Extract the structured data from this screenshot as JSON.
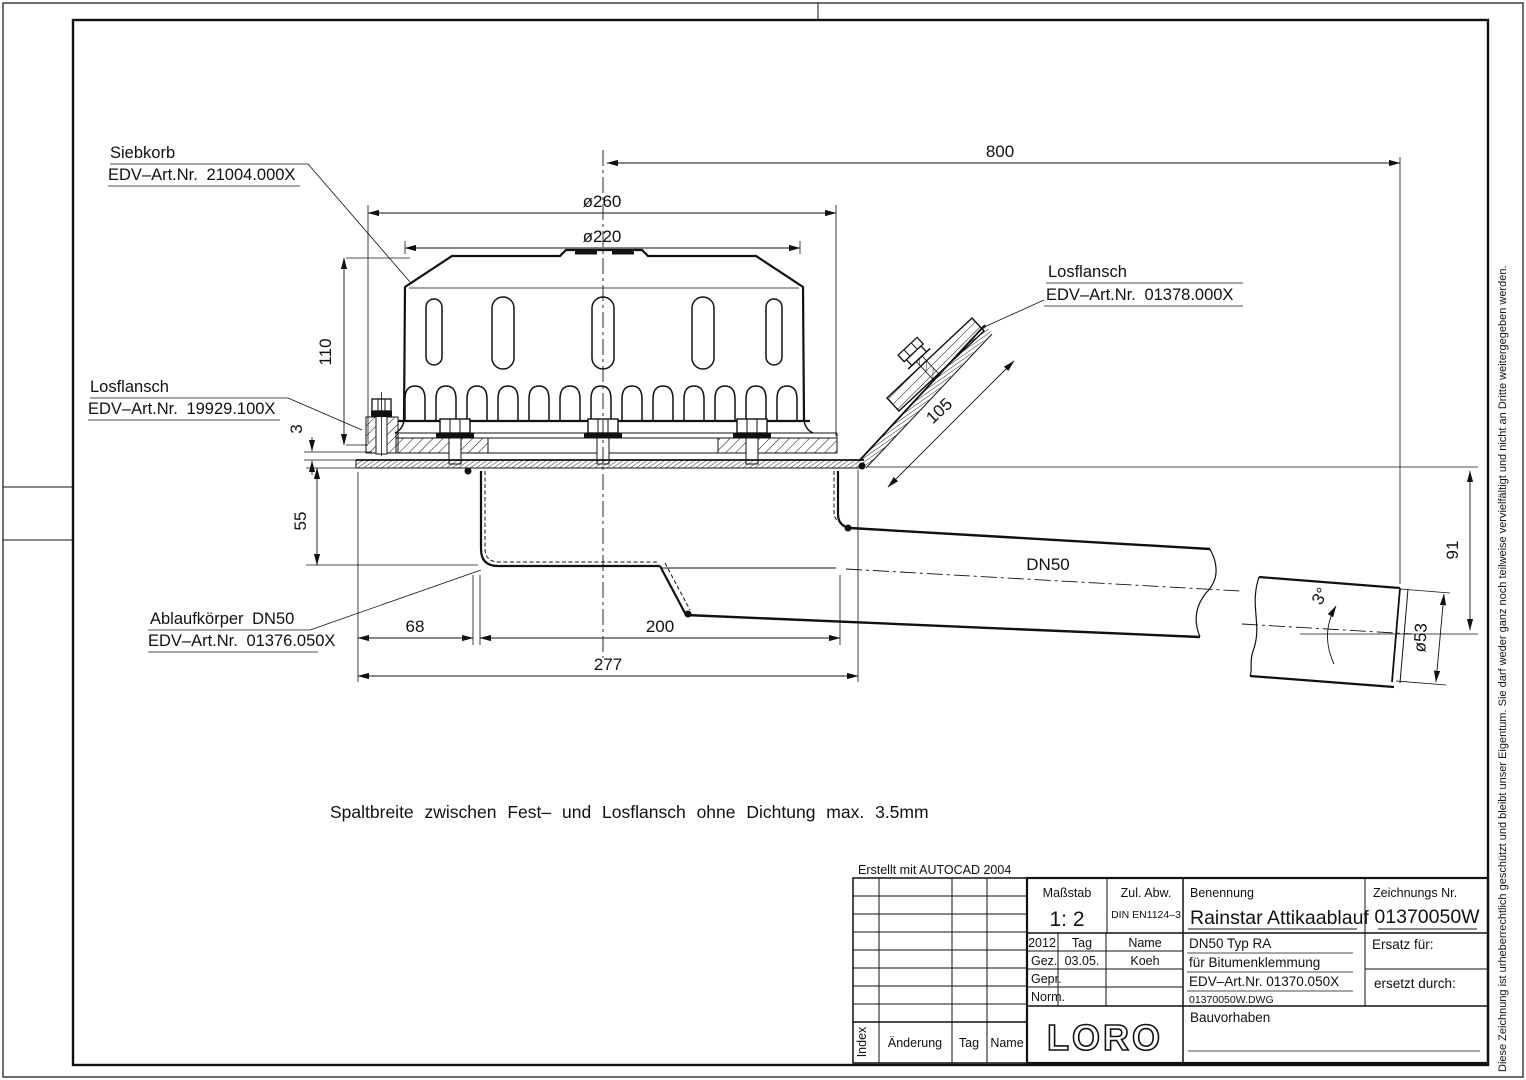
{
  "drawing": {
    "labels": {
      "siebkorb": {
        "l1": "Siebkorb",
        "l2": "EDV–Art.Nr.  21004.000X"
      },
      "losflansch_l": {
        "l1": "Losflansch",
        "l2": "EDV–Art.Nr.  19929.100X"
      },
      "losflansch_r": {
        "l1": "Losflansch",
        "l2": "EDV–Art.Nr.  01378.000X"
      },
      "ablauf": {
        "l1": "Ablaufkörper  DN50",
        "l2": "EDV–Art.Nr.  01376.050X"
      },
      "dn50": "DN50"
    },
    "dims": {
      "d800": "800",
      "d260": "ø260",
      "d220": "ø220",
      "d110": "110",
      "d3": "3",
      "d55": "55",
      "d68": "68",
      "d200": "200",
      "d277": "277",
      "d105": "105",
      "d91": "91",
      "d53": "ø53",
      "a3": "3°"
    },
    "note": "Spaltbreite  zwischen  Fest–  und  Losflansch  ohne  Dichtung  max.  3.5mm"
  },
  "titleblock": {
    "created": "Erstellt  mit  AUTOCAD  2004",
    "massstab_l": "Maßstab",
    "massstab_v": "1: 2",
    "zul_l": "Zul.  Abw.",
    "zul_v": "DIN EN1124–3",
    "benennung_l": "Benennung",
    "benennung_v": "Rainstar  Attikaablauf",
    "znr_l": "Zeichnungs  Nr.",
    "znr_v": "01370050W",
    "year": "2012",
    "tag": "Tag",
    "name": "Name",
    "gez": "Gez.",
    "gez_tag": "03.05.",
    "gez_name": "Koeh",
    "gepr": "Gepr.",
    "norm": "Norm.",
    "p1": "DN50  Typ  RA",
    "p2": "für  Bitumenklemmung",
    "p3": "EDV–Art.Nr.  01370.050X",
    "p4": "01370050W.DWG",
    "ersatz": "Ersatz  für:",
    "ersetzt": "ersetzt  durch:",
    "bau": "Bauvorhaben",
    "logo": "LORO",
    "idx": "Index",
    "aend": "Änderung",
    "tag2": "Tag",
    "name2": "Name"
  },
  "copyright": "Diese Zeichnung ist urheberrechtlich geschützt und bleibt unser Eigentum. Sie darf weder ganz noch teilweise vervielfältigt und nicht an Dritte weitergegeben werden."
}
